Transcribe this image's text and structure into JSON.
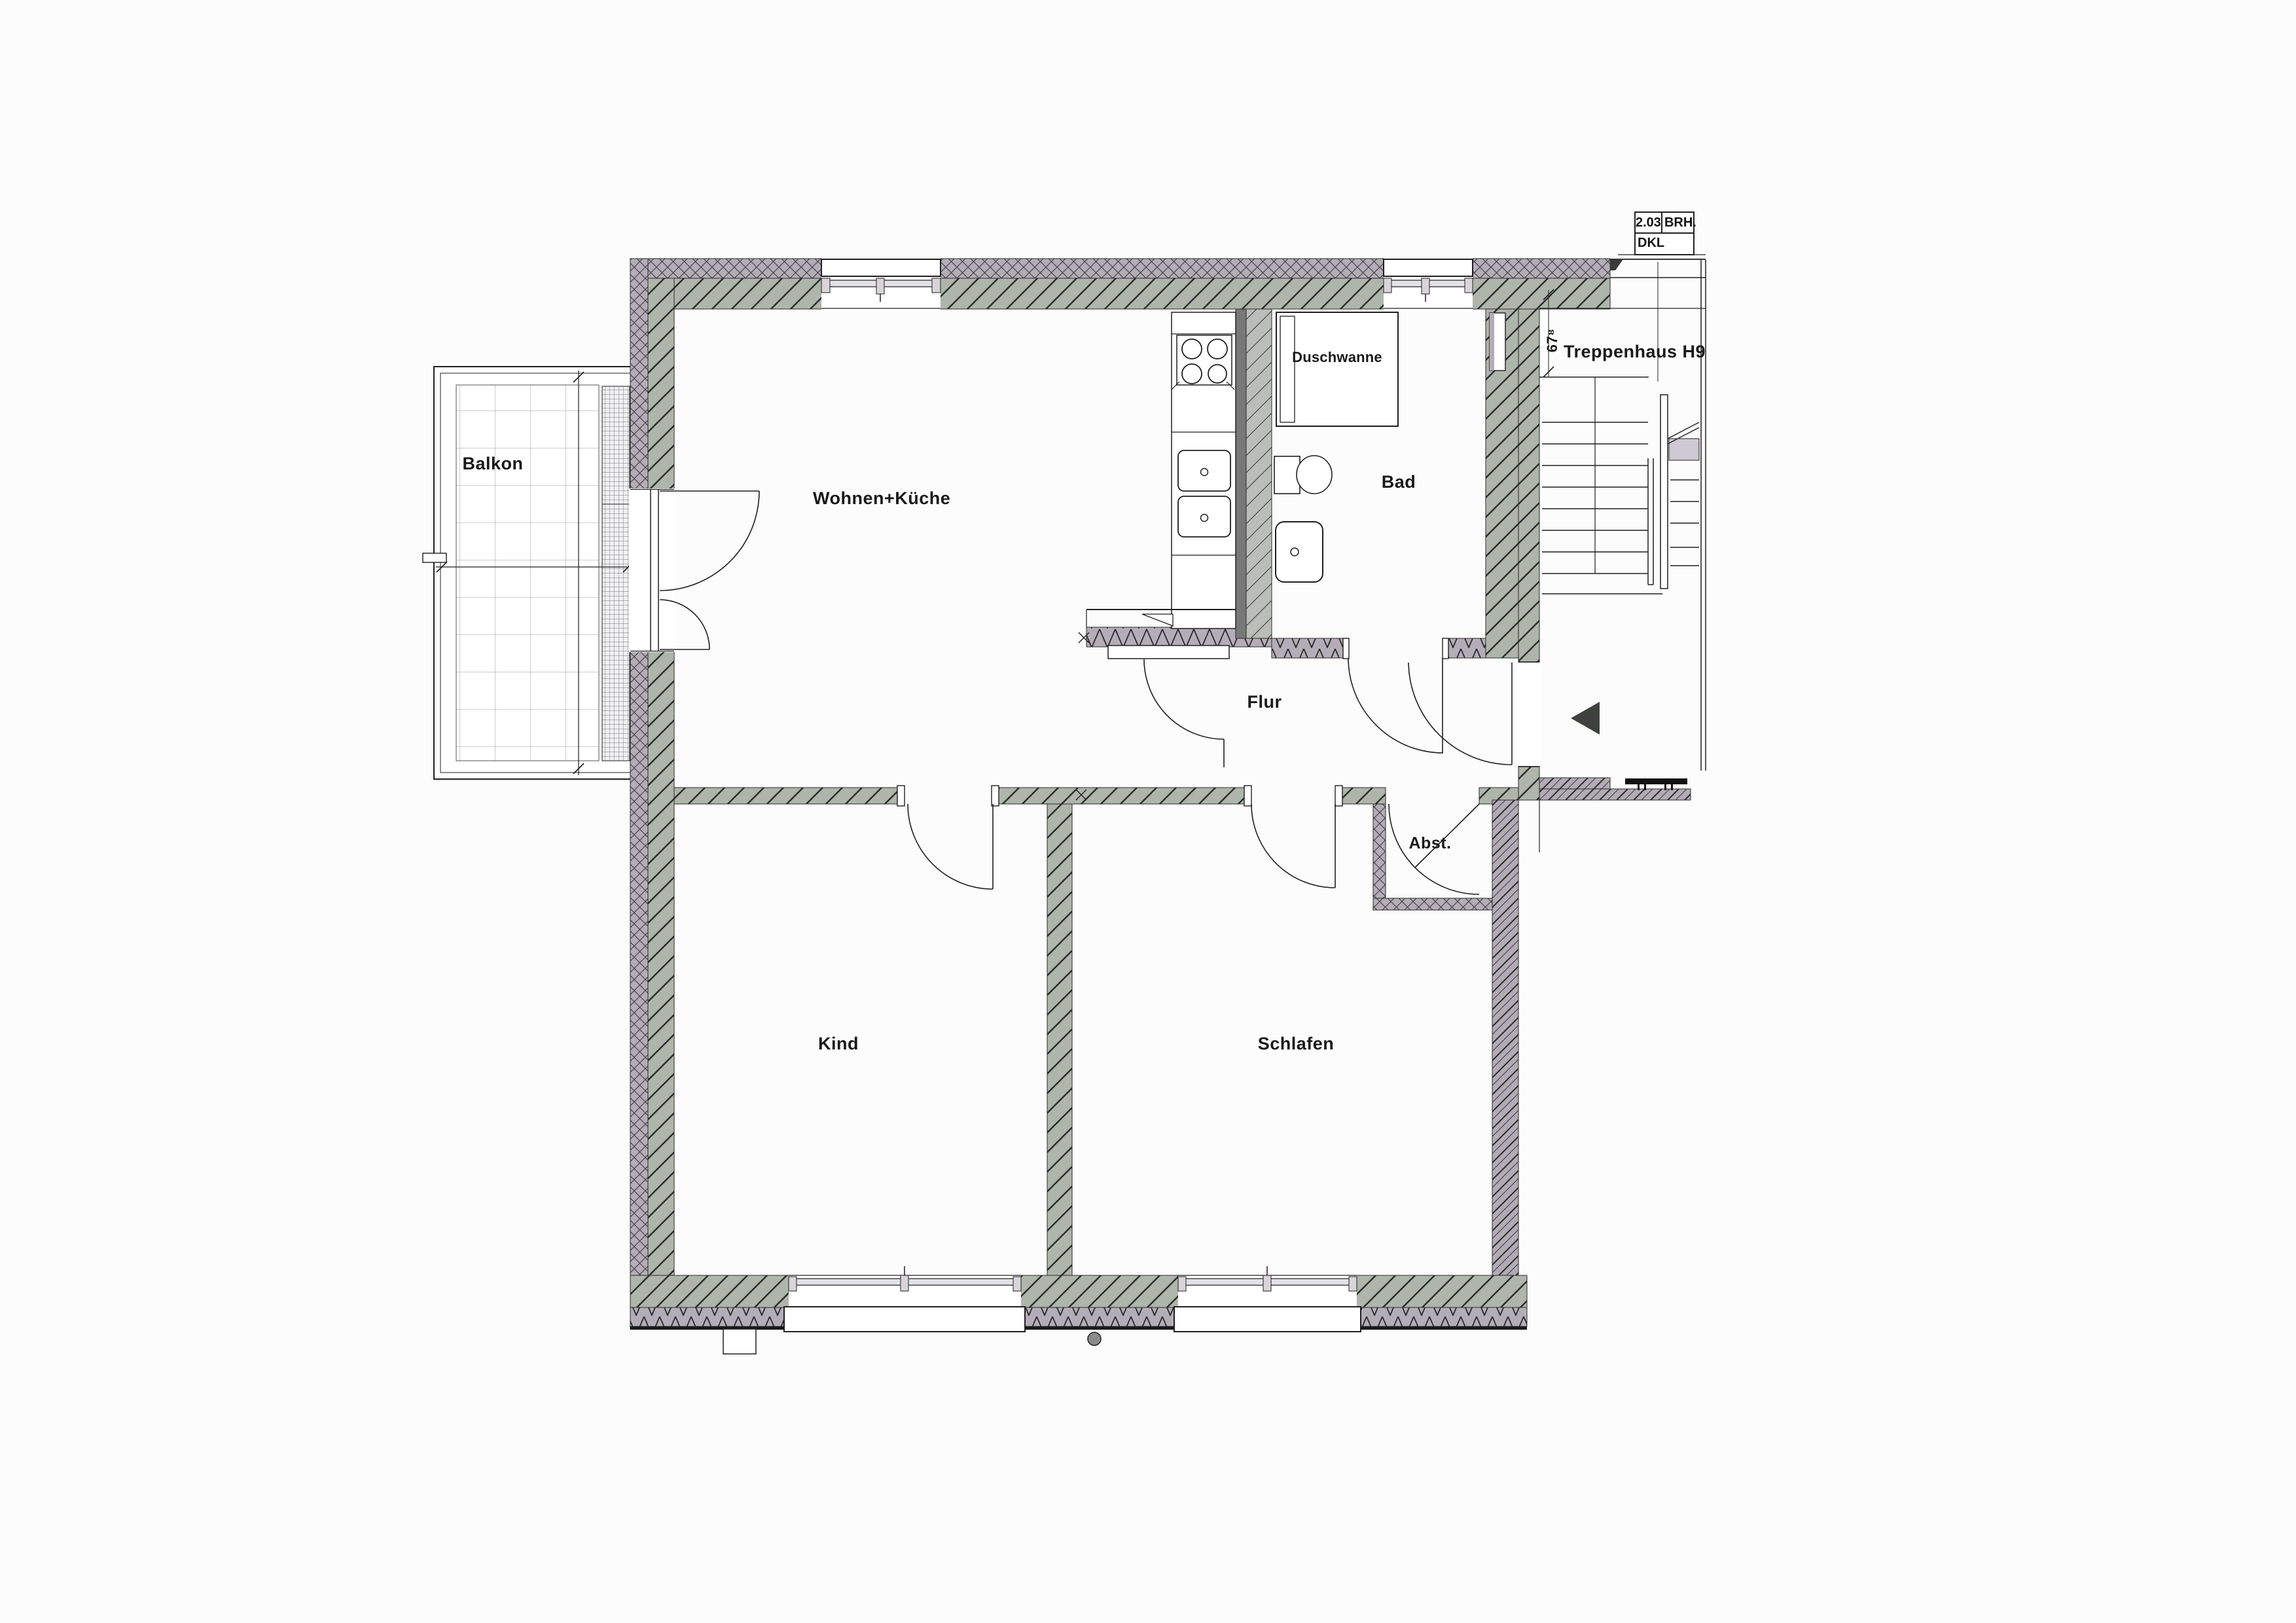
{
  "info_box": {
    "room_number": "2.03",
    "top_right": "BRH.",
    "bottom": "DKL"
  },
  "labels": {
    "balkon": "Balkon",
    "wohnen_kueche": "Wohnen+Küche",
    "duschwanne": "Duschwanne",
    "bad": "Bad",
    "treppenhaus": "Treppenhaus H9",
    "flur": "Flur",
    "kind": "Kind",
    "schlafen": "Schlafen",
    "abst": "Abst.",
    "sill_dimension": "67⁸"
  },
  "colors": {
    "wall_masonry_green": "#aeb5ab",
    "wall_insulation_purple": "#b4adb8",
    "landing_light_purple": "#cfc9d3",
    "line": "#1f1f1f",
    "entrance_arrow": "#3d423d",
    "paper": "#fcfcfc"
  }
}
